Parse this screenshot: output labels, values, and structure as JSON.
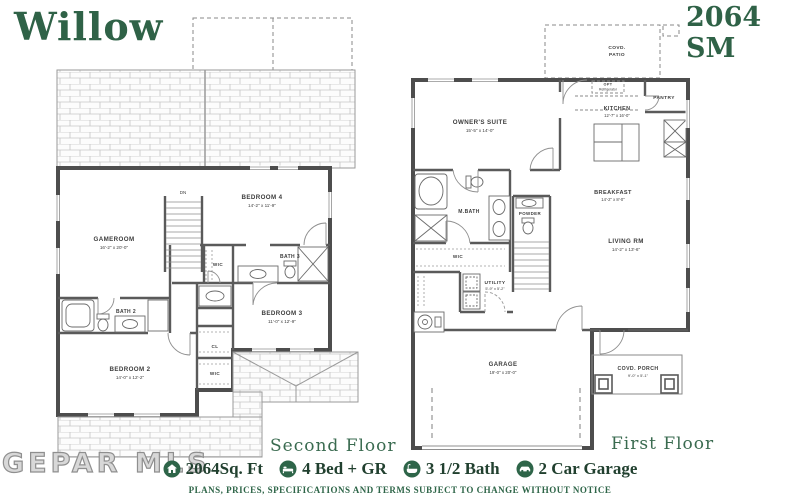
{
  "header": {
    "plan_name": "Willow",
    "plan_code": "2064 SM"
  },
  "second_floor": {
    "label": "Second Floor",
    "stairs_label": "DN",
    "rooms": {
      "gameroom": {
        "name": "GAMEROOM",
        "dims": "16'-2\" x 20'-0\""
      },
      "bedroom4": {
        "name": "BEDROOM 4",
        "dims": "14'-2\" x 11'-9\""
      },
      "bedroom3": {
        "name": "BEDROOM 3",
        "dims": "11'-0\" x 12'-9\""
      },
      "bedroom2": {
        "name": "BEDROOM 2",
        "dims": "14'-0\" x 12'-2\""
      },
      "bath2": {
        "name": "BATH 2"
      },
      "bath3": {
        "name": "BATH 3"
      },
      "wic_hall": {
        "name": "WIC"
      },
      "wic_bedroom2": {
        "name": "WIC"
      },
      "closet": {
        "name": "CL"
      }
    }
  },
  "first_floor": {
    "label": "First Floor",
    "rooms": {
      "covd_patio": {
        "line1": "COVD.",
        "line2": "PATIO"
      },
      "owners_suite": {
        "name": "OWNER'S SUITE",
        "dims": "15'-5\" x 14'-0\""
      },
      "kitchen": {
        "name": "KITCHEN",
        "dims": "12'-7\" x 16'-0\""
      },
      "pantry": {
        "name": "PANTRY"
      },
      "opt_refrigerator": {
        "line1": "OPT",
        "line2": "Refrigerator"
      },
      "breakfast": {
        "name": "BREAKFAST",
        "dims": "14'-2\" x 8'-0\""
      },
      "living_rm": {
        "name": "LIVING RM",
        "dims": "14'-2\" x 13'-6\""
      },
      "m_bath": {
        "name": "M.BATH"
      },
      "wic": {
        "name": "WIC"
      },
      "powder": {
        "name": "POWDER"
      },
      "utility": {
        "name": "UTILITY",
        "dims": "5'-9\" x 5'-2\""
      },
      "garage": {
        "name": "GARAGE",
        "dims": "19'-0\" x 20'-0\""
      },
      "covd_porch": {
        "name": "COVD. PORCH",
        "dims": "9'-0\" x 5'-1\""
      }
    }
  },
  "footer": {
    "sqft": "2064Sq. Ft",
    "beds": "4 Bed + GR",
    "baths": "3 1/2 Bath",
    "garage": "2 Car Garage",
    "disclaimer": "PLANS, PRICES, SPECIFICATIONS AND TERMS SUBJECT TO CHANGE WITHOUT NOTICE"
  },
  "watermark": "GEPAR MLS",
  "colors": {
    "accent_green": "#2f6247",
    "wall_gray": "#4d4d4d"
  }
}
